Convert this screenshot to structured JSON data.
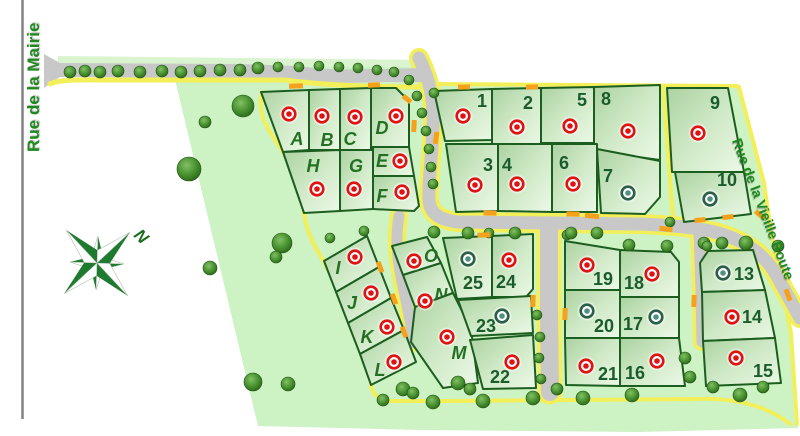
{
  "canvas": {
    "width": 800,
    "height": 436
  },
  "streets": {
    "left": "Rue de la Mairie",
    "right": "Rue de la Vieille Route"
  },
  "compass": {
    "label": "N"
  },
  "colors": {
    "site": "#cdf2c3",
    "lawn": "#d9f4cf",
    "lot_border": "#1c5e20",
    "road": "#c8c8c8",
    "sidewalk": "#f3ef59",
    "orange": "#f5a11c",
    "street_text": "#1e8a1e",
    "letter_text": "#237023",
    "number_text": "#1a5c2c",
    "marker_red": "#e01212",
    "marker_green_ring": "#2c5f4a",
    "marker_green_dot": "#4f9180"
  },
  "map": {
    "site_outline": "M172,67 L424,67 L433,86 L737,86 L765,185 L772,235 L792,335 L798,428 L640,432 L420,430 L258,426 Z",
    "tree_lawn": "58,56 424,60 424,75 58,72",
    "roads": {
      "top_road": "M44,54 L60,63 L240,64 L300,66 C330,71 350,69 380,69 L424,68 L424,82 L380,82 C350,83 330,84 300,80 L240,78 L60,77 L44,88 Z",
      "top_sidewalk": "M50,84 C60,79 80,80 120,80 L285,80 C330,86 380,87 428,87",
      "main": "M419,58 C430,80 434,100 433,125 C432,160 428,180 429,200 C430,214 440,220 458,222 L640,224 C690,226 715,230 735,239 C757,249 770,262 779,280 L800,318",
      "stub_left": "M399,216 C394,245 399,270 406,300 L412,332 C413,341 410,344 407,346",
      "stub_mid": "M549,228 L549,310 L550,392",
      "stub_right": "M699,232 L701,290 L702,342"
    },
    "sidewalks": [
      {
        "d": "M262,92 C256,115 270,132 283,152 C296,172 301,192 304,213 C306,232 315,247 324,262 C335,282 346,303 357,327 C364,342 369,364 371,385 C373,396 380,400 391,401 L450,401 L700,399 C740,398 770,408 790,424",
        "w": 4
      },
      {
        "d": "M739,87 L764,183 L771,232 L791,333 L797,424",
        "w": 4
      },
      {
        "d": "M432,84 L737,86",
        "w": 4
      },
      {
        "d": "M663,87 L673,218",
        "w": 4
      }
    ],
    "lots": [
      {
        "id": "A",
        "label": "A",
        "kind": "letter",
        "status": "red",
        "points": "261,92 309,90 309,150 283,152",
        "label_xy": [
          297,
          139
        ],
        "marker_xy": [
          289,
          114
        ]
      },
      {
        "id": "B",
        "label": "B",
        "kind": "letter",
        "status": "red",
        "points": "309,90 340,89 340,150 309,150",
        "label_xy": [
          327,
          140
        ],
        "marker_xy": [
          322,
          116
        ]
      },
      {
        "id": "C",
        "label": "C",
        "kind": "letter",
        "status": "red",
        "points": "340,89 371,88 371,150 340,150",
        "label_xy": [
          350,
          139
        ],
        "marker_xy": [
          355,
          117
        ]
      },
      {
        "id": "D",
        "label": "D",
        "kind": "letter",
        "status": "red",
        "points": "371,88 396,88 409,101 409,147 371,147",
        "label_xy": [
          382,
          128
        ],
        "marker_xy": [
          396,
          116
        ]
      },
      {
        "id": "E",
        "label": "E",
        "kind": "letter",
        "status": "red",
        "points": "373,147 409,147 414,176 373,176",
        "label_xy": [
          382,
          161
        ],
        "marker_xy": [
          400,
          161
        ]
      },
      {
        "id": "F",
        "label": "F",
        "kind": "letter",
        "status": "red",
        "points": "373,176 414,176 419,206 414,211 373,209",
        "label_xy": [
          382,
          196
        ],
        "marker_xy": [
          402,
          192
        ]
      },
      {
        "id": "G",
        "label": "G",
        "kind": "letter",
        "status": "red",
        "points": "340,150 373,150 373,209 340,211",
        "label_xy": [
          356,
          166
        ],
        "marker_xy": [
          354,
          189
        ]
      },
      {
        "id": "H",
        "label": "H",
        "kind": "letter",
        "status": "red",
        "points": "283,152 340,150 340,211 304,213",
        "label_xy": [
          313,
          166
        ],
        "marker_xy": [
          317,
          189
        ]
      },
      {
        "id": "1",
        "label": "1",
        "kind": "number",
        "status": "red",
        "points": "434,91 492,89 492,140 445,141",
        "label_xy": [
          482,
          101
        ],
        "marker_xy": [
          463,
          116
        ]
      },
      {
        "id": "2",
        "label": "2",
        "kind": "number",
        "status": "red",
        "points": "492,89 541,88 541,147 492,147",
        "label_xy": [
          528,
          103
        ],
        "marker_xy": [
          517,
          127
        ]
      },
      {
        "id": "5",
        "label": "5",
        "kind": "number",
        "status": "red",
        "points": "541,88 594,87 594,143 541,143",
        "label_xy": [
          582,
          100
        ],
        "marker_xy": [
          570,
          126
        ]
      },
      {
        "id": "8",
        "label": "8",
        "kind": "number",
        "status": "red",
        "points": "594,87 660,85 660,160 594,151",
        "label_xy": [
          606,
          99
        ],
        "marker_xy": [
          628,
          131
        ]
      },
      {
        "id": "3",
        "label": "3",
        "kind": "number",
        "status": "red",
        "points": "446,144 498,144 498,211 456,212",
        "label_xy": [
          488,
          165
        ],
        "marker_xy": [
          475,
          185
        ]
      },
      {
        "id": "4",
        "label": "4",
        "kind": "number",
        "status": "red",
        "points": "498,144 552,144 552,212 498,211",
        "label_xy": [
          507,
          165
        ],
        "marker_xy": [
          517,
          184
        ]
      },
      {
        "id": "6",
        "label": "6",
        "kind": "number",
        "status": "red",
        "points": "552,144 597,144 597,212 552,212",
        "label_xy": [
          564,
          163
        ],
        "marker_xy": [
          573,
          184
        ]
      },
      {
        "id": "7",
        "label": "7",
        "kind": "number",
        "status": "green",
        "points": "597,149 660,161 660,197 645,214 601,213",
        "label_xy": [
          608,
          176
        ],
        "marker_xy": [
          628,
          193
        ]
      },
      {
        "id": "9",
        "label": "9",
        "kind": "number",
        "status": "red",
        "points": "667,88 728,88 744,172 672,172",
        "label_xy": [
          715,
          103
        ],
        "marker_xy": [
          698,
          133
        ]
      },
      {
        "id": "10",
        "label": "10",
        "kind": "number",
        "status": "green",
        "points": "675,172 744,172 751,214 684,222",
        "label_xy": [
          727,
          180
        ],
        "marker_xy": [
          710,
          199
        ]
      },
      {
        "id": "I",
        "label": "I",
        "kind": "letter",
        "status": "red",
        "points": "324,261 367,236 379,267 336,292",
        "label_xy": [
          338,
          268
        ],
        "marker_xy": [
          355,
          257
        ]
      },
      {
        "id": "J",
        "label": "J",
        "kind": "letter",
        "status": "red",
        "points": "336,292 379,267 391,298 348,323",
        "label_xy": [
          352,
          303
        ],
        "marker_xy": [
          371,
          293
        ]
      },
      {
        "id": "K",
        "label": "K",
        "kind": "letter",
        "status": "red",
        "points": "348,323 391,298 404,330 360,354",
        "label_xy": [
          367,
          337
        ],
        "marker_xy": [
          387,
          327
        ]
      },
      {
        "id": "L",
        "label": "L",
        "kind": "letter",
        "status": "red",
        "points": "360,354 404,330 416,362 371,385",
        "label_xy": [
          380,
          370
        ],
        "marker_xy": [
          394,
          362
        ]
      },
      {
        "id": "O",
        "label": "O",
        "kind": "letter",
        "status": "red",
        "points": "392,246 427,237 441,263 403,275",
        "label_xy": [
          431,
          256
        ],
        "marker_xy": [
          414,
          261
        ]
      },
      {
        "id": "N",
        "label": "N",
        "kind": "letter",
        "status": "red",
        "points": "403,275 441,263 453,293 415,307",
        "label_xy": [
          441,
          295
        ],
        "marker_xy": [
          425,
          301
        ]
      },
      {
        "id": "M",
        "label": "M",
        "kind": "letter",
        "status": "red",
        "points": "415,307 453,293 471,329 478,383 443,388 411,342",
        "label_xy": [
          459,
          353
        ],
        "marker_xy": [
          447,
          337
        ]
      },
      {
        "id": "25",
        "label": "25",
        "kind": "number",
        "status": "green",
        "points": "443,238 492,236 492,297 457,299",
        "label_xy": [
          473,
          283
        ],
        "marker_xy": [
          468,
          259
        ]
      },
      {
        "id": "24",
        "label": "24",
        "kind": "number",
        "status": "red",
        "points": "492,236 533,234 533,289 526,297 492,297",
        "label_xy": [
          506,
          282
        ],
        "marker_xy": [
          509,
          260
        ]
      },
      {
        "id": "23",
        "label": "23",
        "kind": "number",
        "status": "green",
        "points": "458,300 531,296 533,333 471,336",
        "label_xy": [
          486,
          326
        ],
        "marker_xy": [
          502,
          316
        ]
      },
      {
        "id": "22",
        "label": "22",
        "kind": "number",
        "status": "red",
        "points": "470,340 533,335 536,388 483,389",
        "label_xy": [
          500,
          377
        ],
        "marker_xy": [
          512,
          362
        ]
      },
      {
        "id": "19",
        "label": "19",
        "kind": "number",
        "status": "red",
        "points": "565,241 620,250 620,290 565,290",
        "label_xy": [
          603,
          279
        ],
        "marker_xy": [
          587,
          265
        ]
      },
      {
        "id": "18",
        "label": "18",
        "kind": "number",
        "status": "red",
        "points": "620,250 671,252 679,262 679,297 620,297",
        "label_xy": [
          634,
          283
        ],
        "marker_xy": [
          652,
          274
        ]
      },
      {
        "id": "20",
        "label": "20",
        "kind": "number",
        "status": "green",
        "points": "565,290 620,290 620,338 565,338",
        "label_xy": [
          604,
          326
        ],
        "marker_xy": [
          587,
          311
        ]
      },
      {
        "id": "17",
        "label": "17",
        "kind": "number",
        "status": "green",
        "points": "620,297 679,297 679,338 620,338",
        "label_xy": [
          633,
          324
        ],
        "marker_xy": [
          656,
          317
        ]
      },
      {
        "id": "21",
        "label": "21",
        "kind": "number",
        "status": "red",
        "points": "565,338 620,338 620,386 566,385",
        "label_xy": [
          608,
          374
        ],
        "marker_xy": [
          586,
          366
        ]
      },
      {
        "id": "16",
        "label": "16",
        "kind": "number",
        "status": "red",
        "points": "620,338 679,338 685,386 620,386",
        "label_xy": [
          635,
          373
        ],
        "marker_xy": [
          657,
          361
        ]
      },
      {
        "id": "13",
        "label": "13",
        "kind": "number",
        "status": "green",
        "points": "700,263 708,251 753,250 765,290 702,292",
        "label_xy": [
          744,
          274
        ],
        "marker_xy": [
          723,
          273
        ]
      },
      {
        "id": "14",
        "label": "14",
        "kind": "number",
        "status": "red",
        "points": "702,292 765,290 775,338 703,341",
        "label_xy": [
          752,
          317
        ],
        "marker_xy": [
          732,
          317
        ]
      },
      {
        "id": "15",
        "label": "15",
        "kind": "number",
        "status": "red",
        "points": "703,341 775,338 781,383 706,386",
        "label_xy": [
          763,
          371
        ],
        "marker_xy": [
          736,
          358
        ]
      }
    ],
    "trees": [
      [
        70,
        72,
        6
      ],
      [
        85,
        71,
        6
      ],
      [
        100,
        72,
        6
      ],
      [
        118,
        71,
        6
      ],
      [
        140,
        72,
        6
      ],
      [
        162,
        71,
        6
      ],
      [
        181,
        72,
        6
      ],
      [
        200,
        71,
        6
      ],
      [
        220,
        70,
        6
      ],
      [
        240,
        70,
        6
      ],
      [
        258,
        68,
        6
      ],
      [
        278,
        67,
        5
      ],
      [
        299,
        67,
        5
      ],
      [
        319,
        66,
        5
      ],
      [
        339,
        67,
        5
      ],
      [
        358,
        68,
        5
      ],
      [
        377,
        70,
        5
      ],
      [
        394,
        72,
        5
      ],
      [
        409,
        80,
        5
      ],
      [
        417,
        96,
        5
      ],
      [
        422,
        113,
        5
      ],
      [
        426,
        131,
        5
      ],
      [
        429,
        149,
        5
      ],
      [
        431,
        167,
        5
      ],
      [
        433,
        184,
        5
      ],
      [
        434,
        93,
        5
      ],
      [
        243,
        106,
        11
      ],
      [
        205,
        122,
        6
      ],
      [
        189,
        169,
        12
      ],
      [
        282,
        243,
        10
      ],
      [
        276,
        257,
        6
      ],
      [
        210,
        268,
        7
      ],
      [
        253,
        382,
        9
      ],
      [
        288,
        384,
        7
      ],
      [
        330,
        238,
        5
      ],
      [
        364,
        231,
        5
      ],
      [
        434,
        232,
        6
      ],
      [
        468,
        233,
        6
      ],
      [
        489,
        233,
        5
      ],
      [
        515,
        233,
        6
      ],
      [
        567,
        235,
        5
      ],
      [
        571,
        233,
        6
      ],
      [
        597,
        233,
        6
      ],
      [
        629,
        245,
        6
      ],
      [
        667,
        246,
        6
      ],
      [
        704,
        243,
        6
      ],
      [
        707,
        246,
        5
      ],
      [
        722,
        243,
        6
      ],
      [
        746,
        243,
        7
      ],
      [
        670,
        222,
        5
      ],
      [
        778,
        246,
        6
      ],
      [
        537,
        315,
        5
      ],
      [
        540,
        337,
        5
      ],
      [
        539,
        358,
        5
      ],
      [
        541,
        379,
        5
      ],
      [
        557,
        389,
        6
      ],
      [
        383,
        400,
        6
      ],
      [
        403,
        389,
        7
      ],
      [
        413,
        393,
        6
      ],
      [
        433,
        402,
        7
      ],
      [
        458,
        383,
        7
      ],
      [
        470,
        389,
        6
      ],
      [
        483,
        401,
        7
      ],
      [
        533,
        398,
        7
      ],
      [
        583,
        398,
        7
      ],
      [
        632,
        395,
        7
      ],
      [
        685,
        358,
        6
      ],
      [
        690,
        377,
        6
      ],
      [
        713,
        387,
        6
      ],
      [
        740,
        395,
        7
      ],
      [
        763,
        387,
        6
      ]
    ],
    "dashes": [
      [
        296,
        86,
        14,
        5,
        -2
      ],
      [
        374,
        85,
        12,
        5,
        -2
      ],
      [
        407,
        99,
        10,
        5,
        40
      ],
      [
        414,
        126,
        5,
        12,
        3
      ],
      [
        436,
        138,
        5,
        12,
        8
      ],
      [
        464,
        87,
        12,
        5,
        -1
      ],
      [
        532,
        87,
        12,
        5,
        -1
      ],
      [
        490,
        213,
        13,
        5,
        1
      ],
      [
        573,
        214,
        13,
        5,
        1
      ],
      [
        484,
        235,
        13,
        5,
        -2
      ],
      [
        592,
        216,
        14,
        5,
        6
      ],
      [
        666,
        229,
        13,
        5,
        7
      ],
      [
        700,
        220,
        11,
        5,
        -6
      ],
      [
        728,
        217,
        11,
        5,
        -6
      ],
      [
        380,
        267,
        5,
        11,
        -20
      ],
      [
        394,
        299,
        5,
        11,
        -20
      ],
      [
        404,
        332,
        5,
        11,
        -20
      ],
      [
        533,
        301,
        5,
        12,
        2
      ],
      [
        565,
        314,
        5,
        12,
        2
      ],
      [
        694,
        301,
        5,
        12,
        2
      ],
      [
        788,
        295,
        12,
        5,
        70
      ],
      [
        760,
        215,
        12,
        5,
        40
      ]
    ]
  }
}
